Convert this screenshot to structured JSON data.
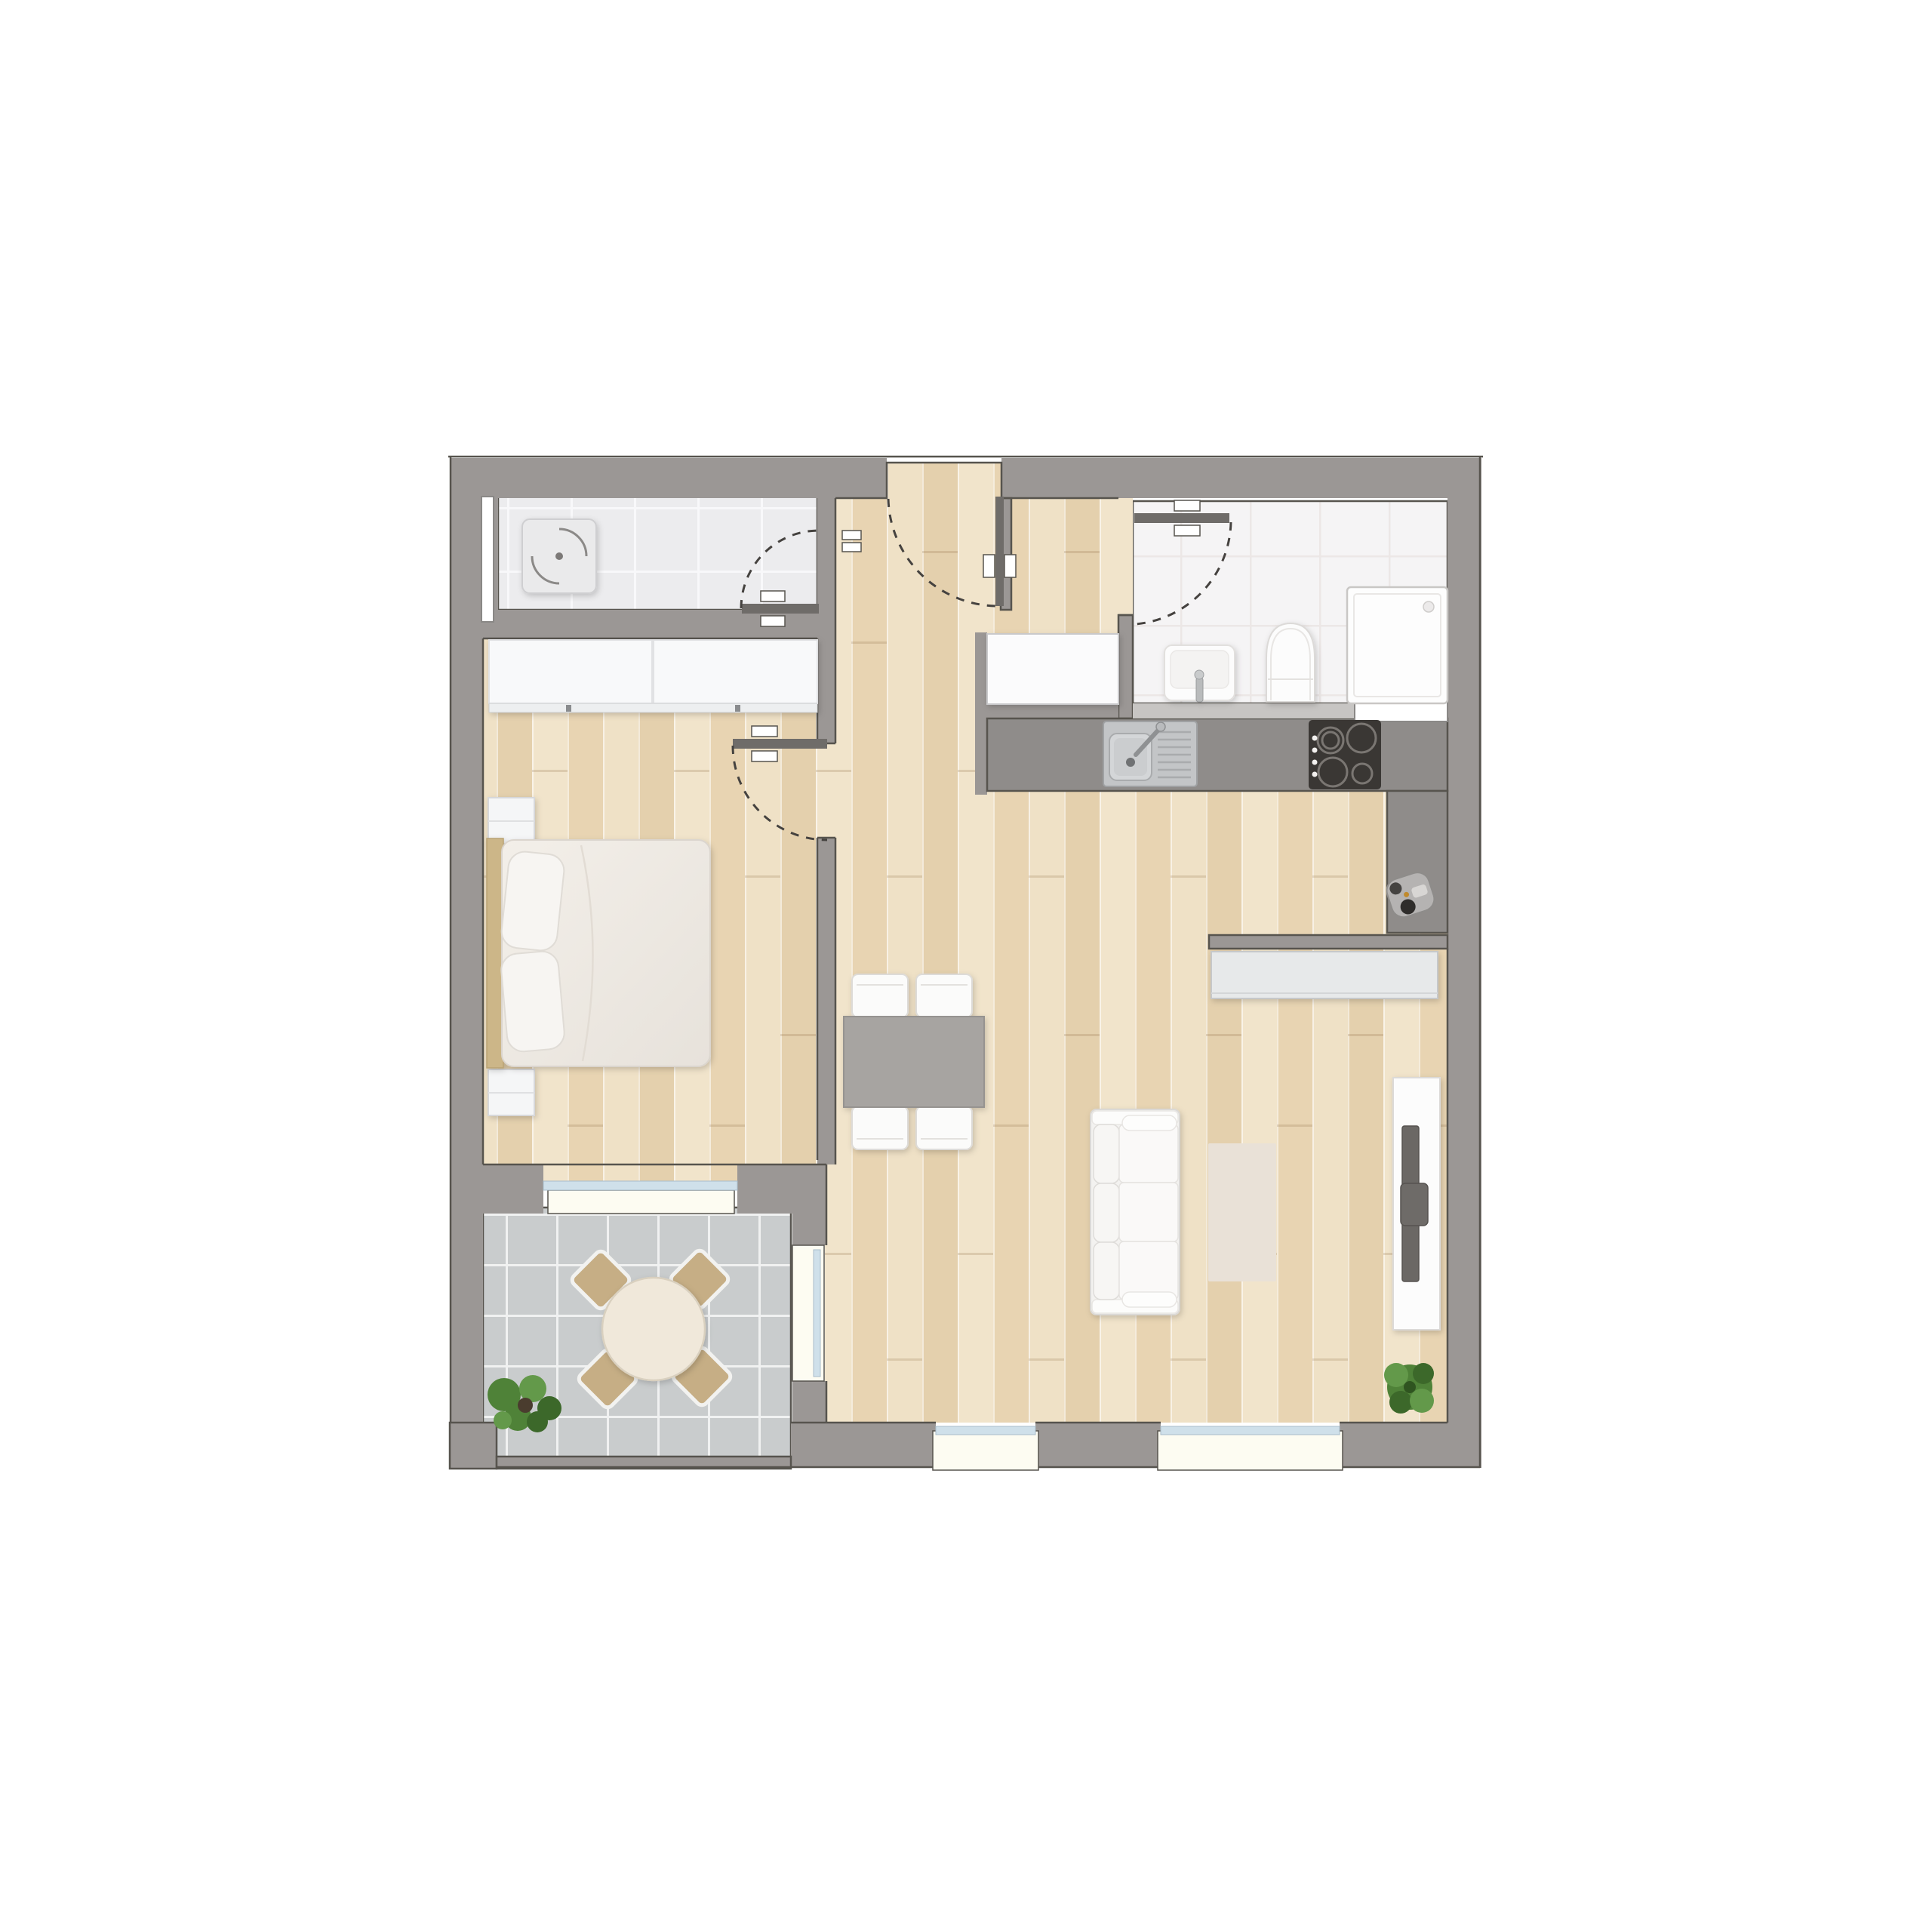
{
  "meta": {
    "type": "architectural-floor-plan",
    "description": "Top-down color floor plan of a one-bedroom apartment with hallway, utility room, bathroom, open kitchen / living / dining room, bedroom and terrace",
    "visible_text": []
  },
  "palette": {
    "wall": "#9b9795",
    "counter": "#8f8c8a",
    "threshold": "#c7c5c3",
    "ink": "#57544e",
    "ink2": "#45423f",
    "door": "#6f6c69",
    "wood-base": "#ecdcc0",
    "wood-a": "#e8d4b2",
    "wood-b": "#efe1c6",
    "wood-c": "#e4d0ad",
    "wood-d": "#f1e4cb",
    "tile-utility": "#ececee",
    "tile-utility-grid": "#f8f8fa",
    "tile-bath": "#f5f4f5",
    "tile-bath-grid": "#ece7e6",
    "tile-terrace": "#c9cccd",
    "tile-terrace-grid": "#f0f1f1",
    "white-furniture": "#fbfbfa",
    "sill": "#fdfcf2",
    "glass": "#cfe0ea",
    "table-gray": "#a7a4a1",
    "rug": "#e9e1d7",
    "chair-tan": "#c6ae85",
    "bed-frame": "#ccb688",
    "mattress": "#eeeae5",
    "tv-dark": "#6b6865",
    "cooktop": "#3a3734",
    "steel": "#c3c5c7",
    "plant-dark": "#3c682a",
    "plant-mid": "#4f8238",
    "plant-light": "#63994a"
  },
  "rooms": [
    {
      "name": "utility-room",
      "floor": "light gray tile"
    },
    {
      "name": "hallway",
      "floor": "light wood parquet"
    },
    {
      "name": "bathroom",
      "floor": "white tile"
    },
    {
      "name": "kitchen",
      "floor": "light wood parquet"
    },
    {
      "name": "living-dining-room",
      "floor": "light wood parquet"
    },
    {
      "name": "bedroom",
      "floor": "light wood parquet"
    },
    {
      "name": "terrace",
      "floor": "gray outdoor tile"
    }
  ],
  "doors": [
    {
      "name": "entrance-door",
      "swing": "into hallway"
    },
    {
      "name": "utility-room-door",
      "swing": "into utility room"
    },
    {
      "name": "bedroom-door",
      "swing": "into bedroom"
    },
    {
      "name": "bathroom-door",
      "swing": "into bathroom"
    },
    {
      "name": "terrace-door",
      "type": "glazed"
    }
  ],
  "windows": [
    {
      "name": "utility-window",
      "wall": "west"
    },
    {
      "name": "bedroom-window",
      "wall": "south"
    },
    {
      "name": "living-window-small",
      "wall": "south"
    },
    {
      "name": "living-window-large",
      "wall": "south"
    },
    {
      "name": "bathroom-niche",
      "wall": "south"
    }
  ],
  "fixtures": [
    "washing-machine",
    "washbasin",
    "toilet",
    "shower",
    "kitchen-sink",
    "cooktop",
    "kitchen-counter",
    "entry-cabinet",
    "threshold-ledge",
    "small-appliance"
  ],
  "furniture": [
    "wardrobe",
    "double-bed",
    "pillows",
    "nightstand-top",
    "nightstand-bottom",
    "dining-table",
    "dining-chairs-x4",
    "sofa-3-seat",
    "rug",
    "sideboard",
    "tv-lowboard",
    "tv",
    "terrace-table",
    "terrace-chairs-x4",
    "terrace-plant",
    "indoor-plant"
  ]
}
